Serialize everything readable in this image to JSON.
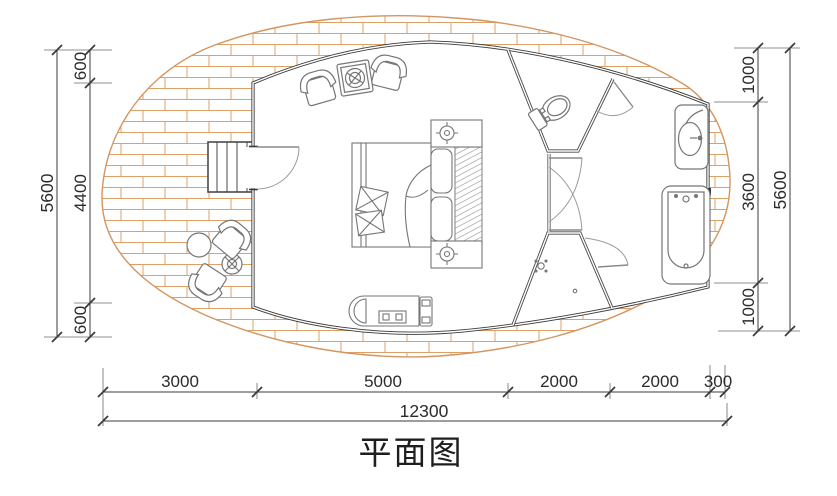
{
  "title": "平面图",
  "dimensions": {
    "left": {
      "total": "5600",
      "segments": [
        "600",
        "4400",
        "600"
      ]
    },
    "right": {
      "total": "5600",
      "segments": [
        "1000",
        "3600",
        "1000"
      ]
    },
    "bottom": {
      "total": "12300",
      "segments": [
        "3000",
        "5000",
        "2000",
        "2000",
        "300"
      ]
    }
  },
  "colors": {
    "background": "#ffffff",
    "brick_hatch": "#dda066",
    "wall": "#3a3a3a",
    "partition": "#6f6f6f",
    "furniture_line": "#767676",
    "dimension_line": "#3b3b3b",
    "text": "#2b2b2b"
  },
  "furniture": {
    "deck": [
      "entry-stairs",
      "round-table",
      "fan-side-table",
      "outdoor-chair-upper",
      "outdoor-chair-lower"
    ],
    "bedroom": [
      "armchair-left",
      "plant-side-table",
      "armchair-right",
      "double-bed",
      "throw-pillows",
      "duvet",
      "headboard-pillows",
      "headboard-rug",
      "nightstand-with-lamp-top",
      "nightstand-with-lamp-bottom",
      "bench-unit"
    ],
    "bathroom": [
      "toilet",
      "washbasin",
      "bathtub",
      "shower-area"
    ]
  }
}
